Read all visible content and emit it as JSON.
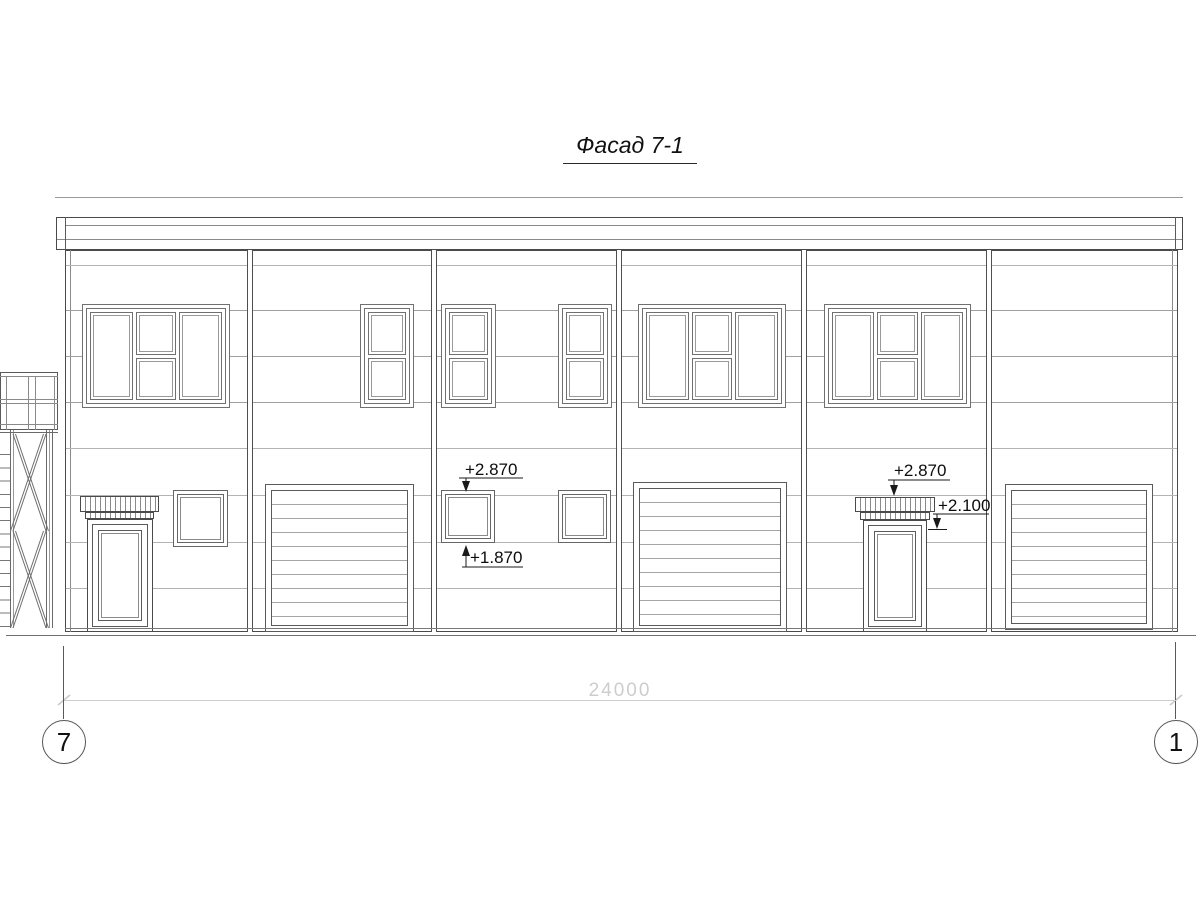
{
  "title": "Фасад 7-1",
  "annotations": {
    "mid_window_top": "+2.870",
    "mid_window_bottom": "+1.870",
    "right_canopy_top": "+2.870",
    "right_canopy_bottom": "+2.100"
  },
  "dimensions": {
    "overall_width": "24000"
  },
  "grid_axes": {
    "left_label": "7",
    "right_label": "1"
  },
  "colors": {
    "outline_dark": "#4a4a4a",
    "frame_gray": "#707070",
    "panel_joint_gray": "#b3b3b3",
    "dimension_gray": "#cdcdcd",
    "background": "#ffffff"
  }
}
